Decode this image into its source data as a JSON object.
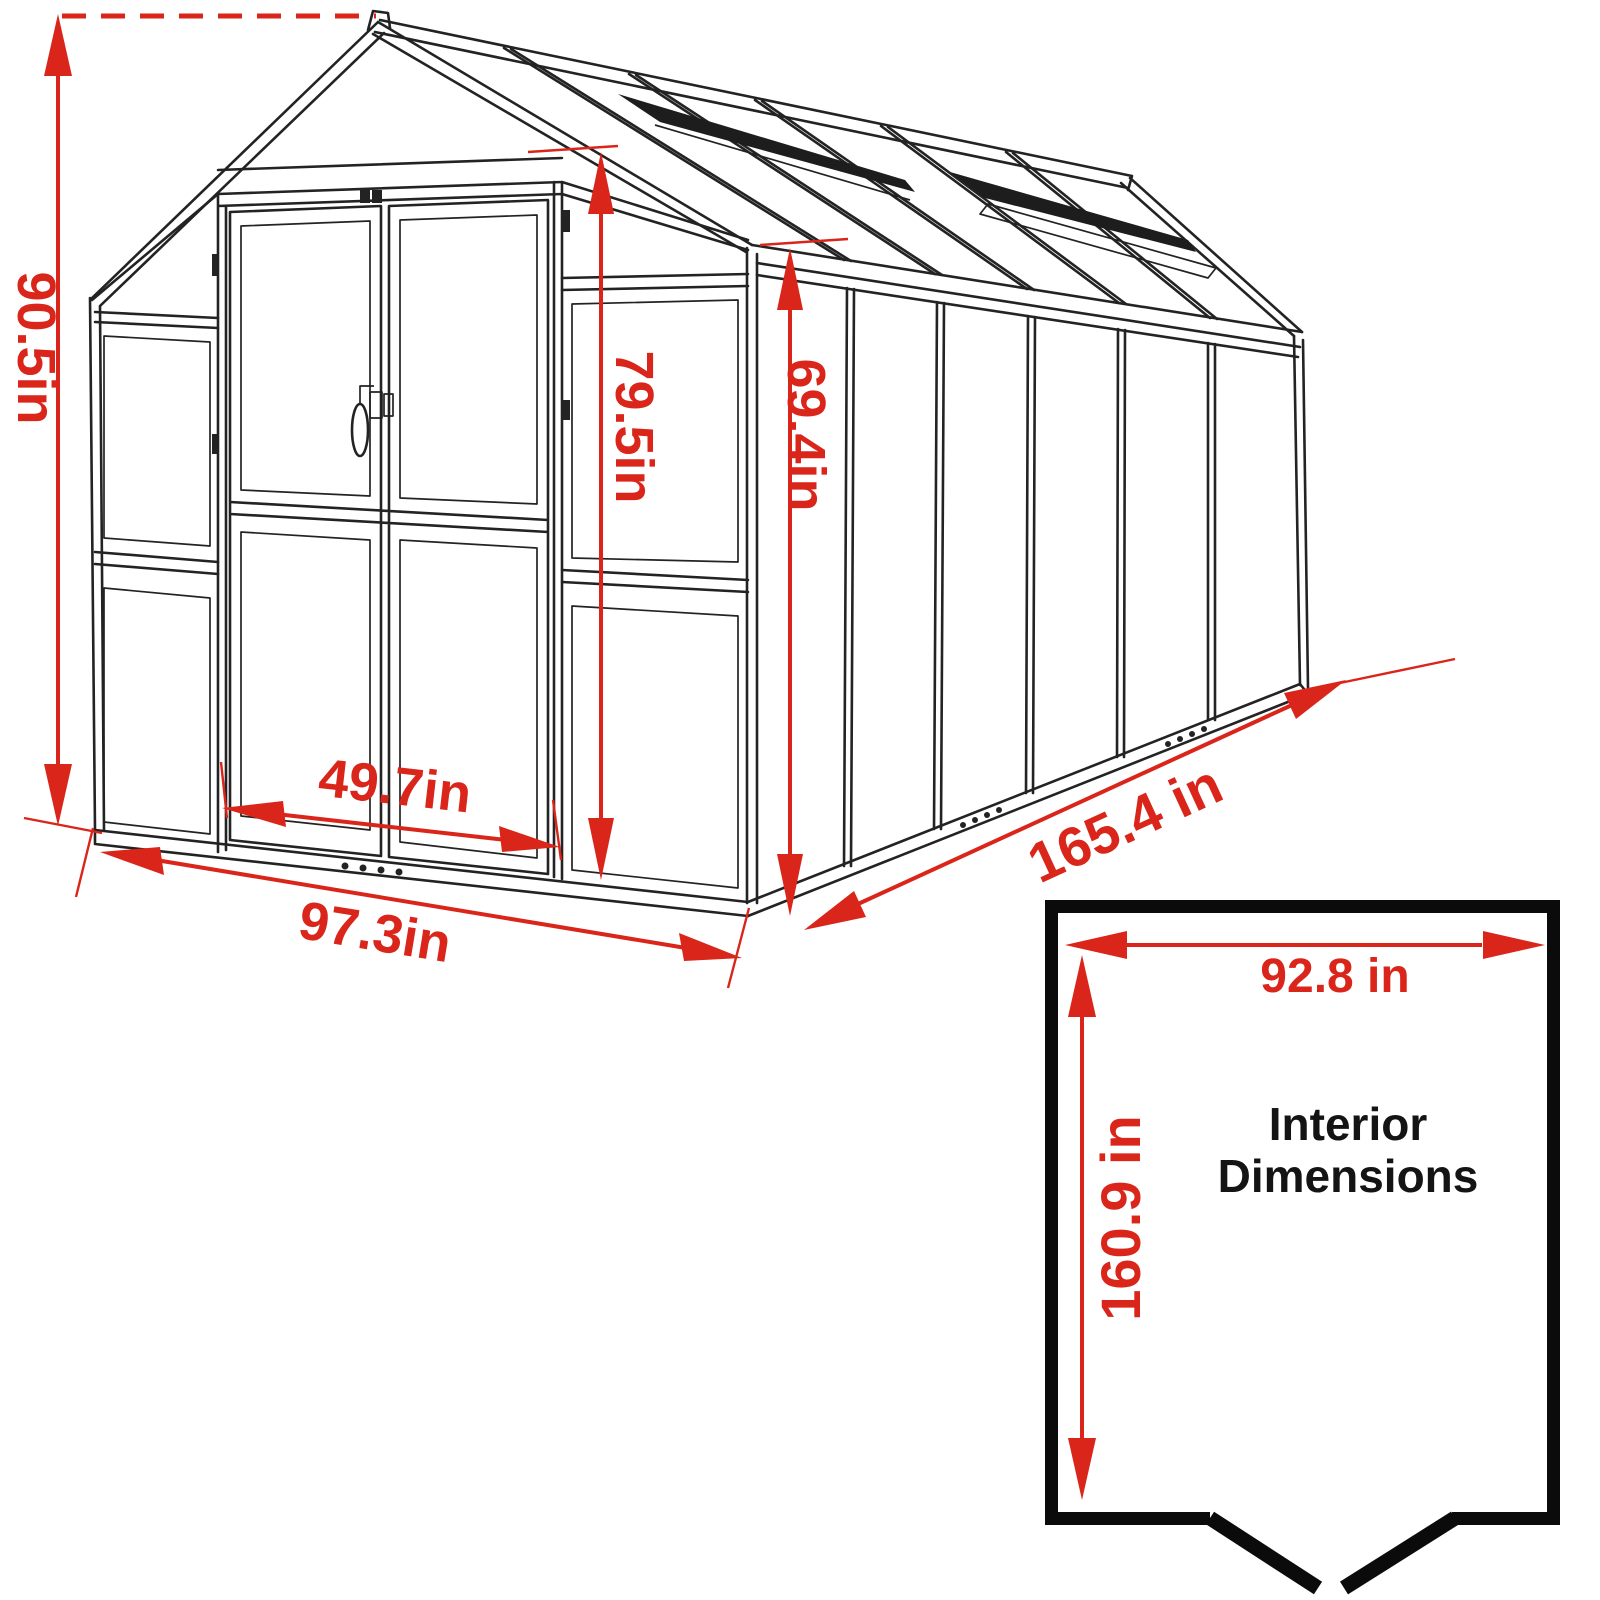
{
  "diagram": {
    "subject": "greenhouse-exterior-dimension-drawing",
    "units": "inches",
    "dimensions": {
      "overall_height": "90.5in",
      "front_wall_height": "79.5in",
      "side_wall_height": "69.4in",
      "door_width": "49.7in",
      "front_width": "97.3in",
      "side_length": "165.4 in"
    },
    "interior": {
      "width": "92.8 in",
      "length": "160.9 in",
      "caption_line1": "Interior",
      "caption_line2": "Dimensions"
    }
  },
  "colors": {
    "background": "#ffffff",
    "line_black": "#232323",
    "dimension_red": "#da251a",
    "interior_border": "#0b0b0b"
  }
}
